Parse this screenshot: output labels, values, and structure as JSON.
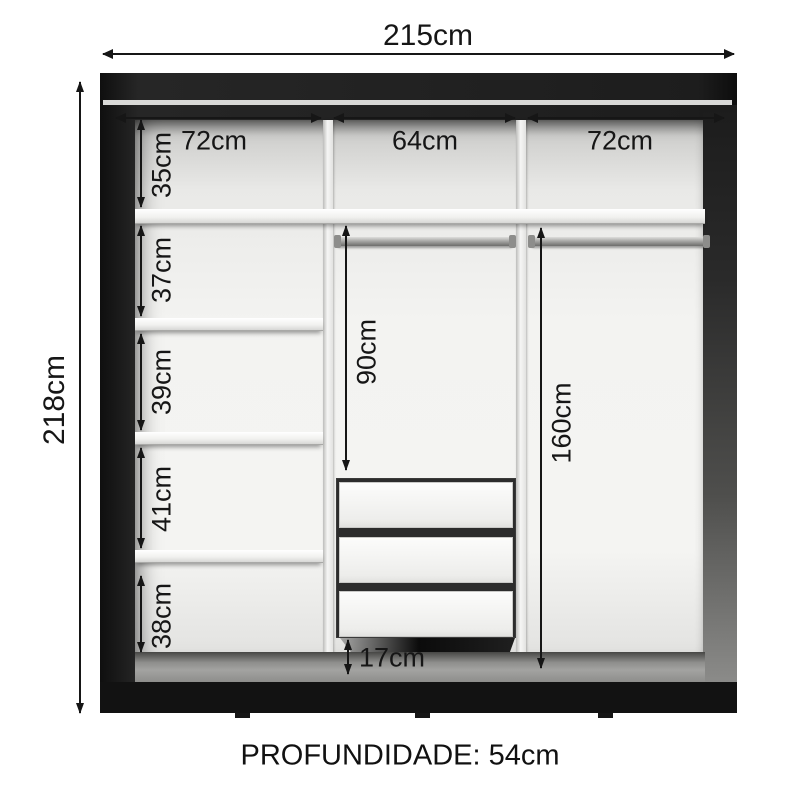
{
  "diagram_title": "Wardrobe internal dimensions diagram",
  "labels": {
    "total_width": "215cm",
    "total_height": "218cm",
    "depth": "PROFUNDIDADE: 54cm",
    "top_widths": [
      "72cm",
      "64cm",
      "72cm"
    ],
    "left_gaps": [
      "35cm",
      "37cm",
      "39cm",
      "41cm",
      "38cm"
    ],
    "middle_hang": "90cm",
    "drawer_gap": "17cm",
    "right_hang": "160cm"
  },
  "furniture": {
    "drawer_count": 3,
    "left_shelf_count": 4,
    "hanging_rod_count": 2,
    "section_count": 3
  },
  "colors": {
    "frame": "#1c1c1c",
    "interior": "#f3f3f1",
    "shelf": "#fafafa",
    "dimension_text": "#161616",
    "background": "#ffffff"
  }
}
